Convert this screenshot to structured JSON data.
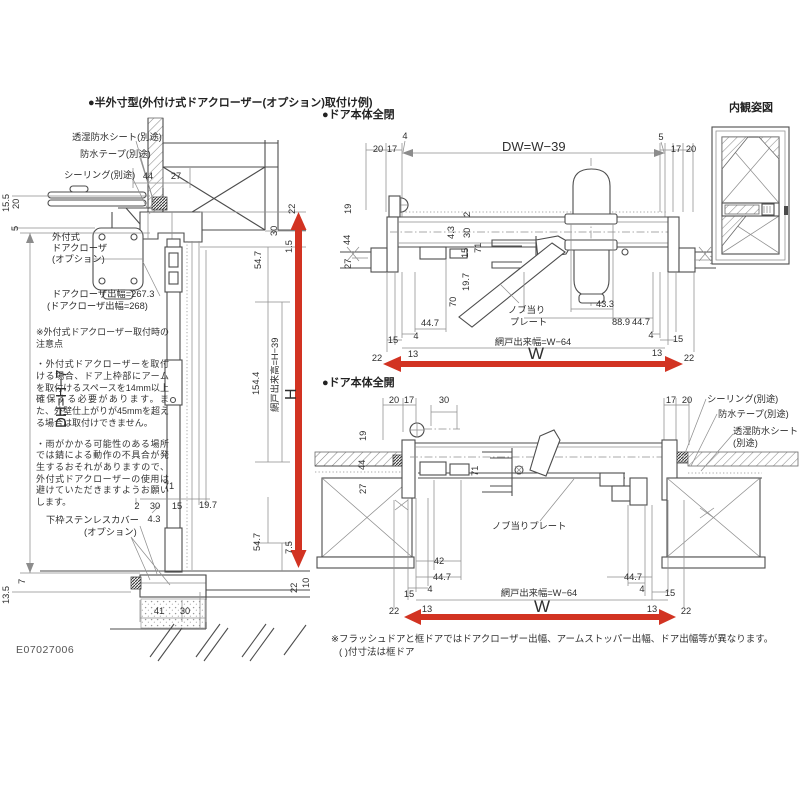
{
  "page": {
    "drawing_code": "E07027006",
    "accent_red": "#d23322",
    "line_color": "#4d4d4d"
  },
  "titles": {
    "left": "●半外寸型(外付け式ドアクローザー(オプション)取付け例)",
    "closed": "●ドア本体全閉",
    "open": "●ドア本体全開",
    "elevation": "内観姿図"
  },
  "notes": {
    "caution_heading": "※外付式ドアクローザー取付時の注意点",
    "caution_1": "・外付式ドアクローザーを取付ける場合、ドア上枠部にアームを取付けるスペースを14mm以上確保する必要があります。また、外壁仕上がりが45mmを超える場合は取付けできません。",
    "caution_2": "・雨がかかる可能性のある場所では錆による動作の不具合が発生するおそれがありますので、外付式ドアクローザーの使用は避けていただきますようお願いします。",
    "footnote_1": "※フラッシュドアと框ドアではドアクローザー出幅、アームストッパー出幅、ドア出幅等が異なります。",
    "footnote_2": "( )付寸法は框ドア"
  },
  "annotations": [
    {
      "group": "left-callouts",
      "items": [
        {
          "t": "透湿防水シート(別途)",
          "x": 72,
          "y": 140,
          "n": "callout-moisture-sheet"
        },
        {
          "t": "防水テープ(別途)",
          "x": 80,
          "y": 157,
          "n": "callout-waterproof-tape"
        },
        {
          "t": "シーリング(別途)",
          "x": 64,
          "y": 178,
          "n": "callout-sealing"
        },
        {
          "t": "外付式",
          "x": 52,
          "y": 240,
          "n": "callout-door-closer"
        },
        {
          "t": "ドアクローザ",
          "x": 52,
          "y": 251,
          "n": "callout-door-closer-2"
        },
        {
          "t": "(オプション)",
          "x": 52,
          "y": 262,
          "n": "callout-door-closer-3"
        },
        {
          "t": "ドアクローザ出幅=267.3",
          "x": 52,
          "y": 297,
          "n": "closer-projection-label"
        },
        {
          "t": "(ドアクローザ出幅=268)",
          "x": 47,
          "y": 309,
          "n": "closer-projection-alt-label"
        },
        {
          "t": "下枠ステンレスカバー",
          "x": 46,
          "y": 523,
          "n": "callout-sill-cover"
        },
        {
          "t": "(オプション)",
          "x": 84,
          "y": 535,
          "n": "callout-sill-cover-2"
        }
      ]
    },
    {
      "group": "left-dims",
      "items": [
        {
          "t": "44",
          "x": 148,
          "y": 179,
          "a": "middle"
        },
        {
          "t": "27",
          "x": 176,
          "y": 179,
          "a": "middle"
        },
        {
          "t": "15.5",
          "x": 9,
          "y": 212,
          "r": -90
        },
        {
          "t": "20",
          "x": 19,
          "y": 209,
          "r": -90
        },
        {
          "t": "5",
          "x": 18,
          "y": 231,
          "r": -90
        },
        {
          "t": "22",
          "x": 295,
          "y": 214,
          "r": -90
        },
        {
          "t": "30",
          "x": 277,
          "y": 236,
          "r": -90
        },
        {
          "t": "1.5",
          "x": 292,
          "y": 253,
          "r": -90
        },
        {
          "t": "54.7",
          "x": 261,
          "y": 269,
          "r": -90
        },
        {
          "t": "154.4",
          "x": 259,
          "y": 395,
          "r": -90
        },
        {
          "t": "網戸出来高=H−39",
          "x": 278,
          "y": 412,
          "r": -90,
          "n": "screen-height-label"
        },
        {
          "t": "H",
          "x": 296,
          "y": 400,
          "r": -90,
          "s": 16,
          "n": "h-label"
        },
        {
          "t": "DH=H−7",
          "x": 66,
          "y": 428,
          "r": -90,
          "s": 15,
          "n": "dh-label"
        },
        {
          "t": "71",
          "x": 169,
          "y": 489,
          "a": "middle"
        },
        {
          "t": "2",
          "x": 137,
          "y": 509,
          "a": "middle"
        },
        {
          "t": "30",
          "x": 155,
          "y": 509,
          "a": "middle"
        },
        {
          "t": "15",
          "x": 177,
          "y": 509,
          "a": "middle"
        },
        {
          "t": "19.7",
          "x": 208,
          "y": 508,
          "a": "middle"
        },
        {
          "t": "4.3",
          "x": 154,
          "y": 522,
          "a": "middle"
        },
        {
          "t": "54.7",
          "x": 260,
          "y": 551,
          "r": -90
        },
        {
          "t": "7.5",
          "x": 292,
          "y": 554,
          "r": -90
        },
        {
          "t": "7",
          "x": 25,
          "y": 584,
          "r": -90
        },
        {
          "t": "13.5",
          "x": 9,
          "y": 604,
          "r": -90
        },
        {
          "t": "41",
          "x": 159,
          "y": 614,
          "a": "middle"
        },
        {
          "t": "30",
          "x": 185,
          "y": 614,
          "a": "middle"
        },
        {
          "t": "22",
          "x": 297,
          "y": 593,
          "r": -90
        },
        {
          "t": "10",
          "x": 309,
          "y": 588,
          "r": -90
        }
      ]
    },
    {
      "group": "closed-dims",
      "items": [
        {
          "t": "20",
          "x": 378,
          "y": 152,
          "a": "middle"
        },
        {
          "t": "17",
          "x": 392,
          "y": 152,
          "a": "middle"
        },
        {
          "t": "4",
          "x": 405,
          "y": 139,
          "a": "middle"
        },
        {
          "t": "DW=W−39",
          "x": 502,
          "y": 151,
          "s": 13,
          "n": "dw-label"
        },
        {
          "t": "5",
          "x": 661,
          "y": 140,
          "a": "middle"
        },
        {
          "t": "17",
          "x": 676,
          "y": 152,
          "a": "middle"
        },
        {
          "t": "20",
          "x": 691,
          "y": 152,
          "a": "middle"
        },
        {
          "t": "19",
          "x": 351,
          "y": 214,
          "r": -90
        },
        {
          "t": "44",
          "x": 350,
          "y": 245,
          "r": -90
        },
        {
          "t": "27",
          "x": 351,
          "y": 269,
          "r": -90
        },
        {
          "t": "2",
          "x": 470,
          "y": 217,
          "r": -90
        },
        {
          "t": "4.3",
          "x": 454,
          "y": 239,
          "r": -90
        },
        {
          "t": "30",
          "x": 470,
          "y": 238,
          "r": -90
        },
        {
          "t": "15",
          "x": 468,
          "y": 258,
          "r": -90
        },
        {
          "t": "71",
          "x": 481,
          "y": 253,
          "r": -90
        },
        {
          "t": "19.7",
          "x": 469,
          "y": 291,
          "r": -90
        },
        {
          "t": "70",
          "x": 456,
          "y": 307,
          "r": -90
        },
        {
          "t": "44.7",
          "x": 430,
          "y": 326,
          "a": "middle"
        },
        {
          "t": "4",
          "x": 416,
          "y": 339,
          "a": "middle"
        },
        {
          "t": "15",
          "x": 393,
          "y": 343,
          "a": "middle"
        },
        {
          "t": "13",
          "x": 413,
          "y": 357,
          "a": "middle"
        },
        {
          "t": "22",
          "x": 377,
          "y": 361,
          "a": "middle"
        },
        {
          "t": "ノブ当り",
          "x": 508,
          "y": 313,
          "n": "callout-knob-plate"
        },
        {
          "t": "プレート",
          "x": 510,
          "y": 325,
          "n": "callout-knob-plate-2"
        },
        {
          "t": "43.3",
          "x": 605,
          "y": 307,
          "a": "middle"
        },
        {
          "t": "88.9",
          "x": 621,
          "y": 325,
          "a": "middle"
        },
        {
          "t": "44.7",
          "x": 641,
          "y": 325,
          "a": "middle"
        },
        {
          "t": "4",
          "x": 651,
          "y": 338,
          "a": "middle"
        },
        {
          "t": "15",
          "x": 678,
          "y": 342,
          "a": "middle"
        },
        {
          "t": "13",
          "x": 657,
          "y": 356,
          "a": "middle"
        },
        {
          "t": "22",
          "x": 689,
          "y": 361,
          "a": "middle"
        },
        {
          "t": "網戸出来幅=W−64",
          "x": 533,
          "y": 345,
          "a": "middle",
          "n": "screen-width-label"
        },
        {
          "t": "W",
          "x": 536,
          "y": 359,
          "a": "middle",
          "s": 17,
          "n": "w-label"
        }
      ]
    },
    {
      "group": "open-dims",
      "items": [
        {
          "t": "20",
          "x": 394,
          "y": 403,
          "a": "middle"
        },
        {
          "t": "17",
          "x": 409,
          "y": 403,
          "a": "middle"
        },
        {
          "t": "30",
          "x": 444,
          "y": 403,
          "a": "middle"
        },
        {
          "t": "17",
          "x": 671,
          "y": 403,
          "a": "middle"
        },
        {
          "t": "20",
          "x": 687,
          "y": 403,
          "a": "middle"
        },
        {
          "t": "シーリング(別途)",
          "x": 707,
          "y": 402,
          "n": "callout-sealing-open"
        },
        {
          "t": "防水テープ(別途)",
          "x": 718,
          "y": 417,
          "n": "callout-waterproof-tape-open"
        },
        {
          "t": "透湿防水シート",
          "x": 733,
          "y": 434,
          "n": "callout-moisture-sheet-open"
        },
        {
          "t": "(別途)",
          "x": 733,
          "y": 446,
          "n": "callout-moisture-sheet-open-2"
        },
        {
          "t": "19",
          "x": 366,
          "y": 441,
          "r": -90
        },
        {
          "t": "44",
          "x": 365,
          "y": 470,
          "r": -90
        },
        {
          "t": "27",
          "x": 366,
          "y": 494,
          "r": -90
        },
        {
          "t": "71",
          "x": 478,
          "y": 476,
          "r": -90
        },
        {
          "t": "ノブ当りプレート",
          "x": 492,
          "y": 529,
          "n": "callout-knob-plate-open"
        },
        {
          "t": "42",
          "x": 439,
          "y": 564,
          "a": "middle"
        },
        {
          "t": "44.7",
          "x": 442,
          "y": 580,
          "a": "middle"
        },
        {
          "t": "4",
          "x": 430,
          "y": 592,
          "a": "middle"
        },
        {
          "t": "15",
          "x": 409,
          "y": 597,
          "a": "middle"
        },
        {
          "t": "13",
          "x": 427,
          "y": 612,
          "a": "middle"
        },
        {
          "t": "22",
          "x": 394,
          "y": 614,
          "a": "middle"
        },
        {
          "t": "44.7",
          "x": 633,
          "y": 580,
          "a": "middle"
        },
        {
          "t": "4",
          "x": 642,
          "y": 592,
          "a": "middle"
        },
        {
          "t": "15",
          "x": 670,
          "y": 596,
          "a": "middle"
        },
        {
          "t": "13",
          "x": 652,
          "y": 612,
          "a": "middle"
        },
        {
          "t": "22",
          "x": 686,
          "y": 614,
          "a": "middle"
        },
        {
          "t": "網戸出来幅=W−64",
          "x": 539,
          "y": 596,
          "a": "middle",
          "n": "screen-width-label-open"
        },
        {
          "t": "W",
          "x": 542,
          "y": 612,
          "a": "middle",
          "s": 17,
          "n": "w-label-open"
        }
      ]
    }
  ]
}
